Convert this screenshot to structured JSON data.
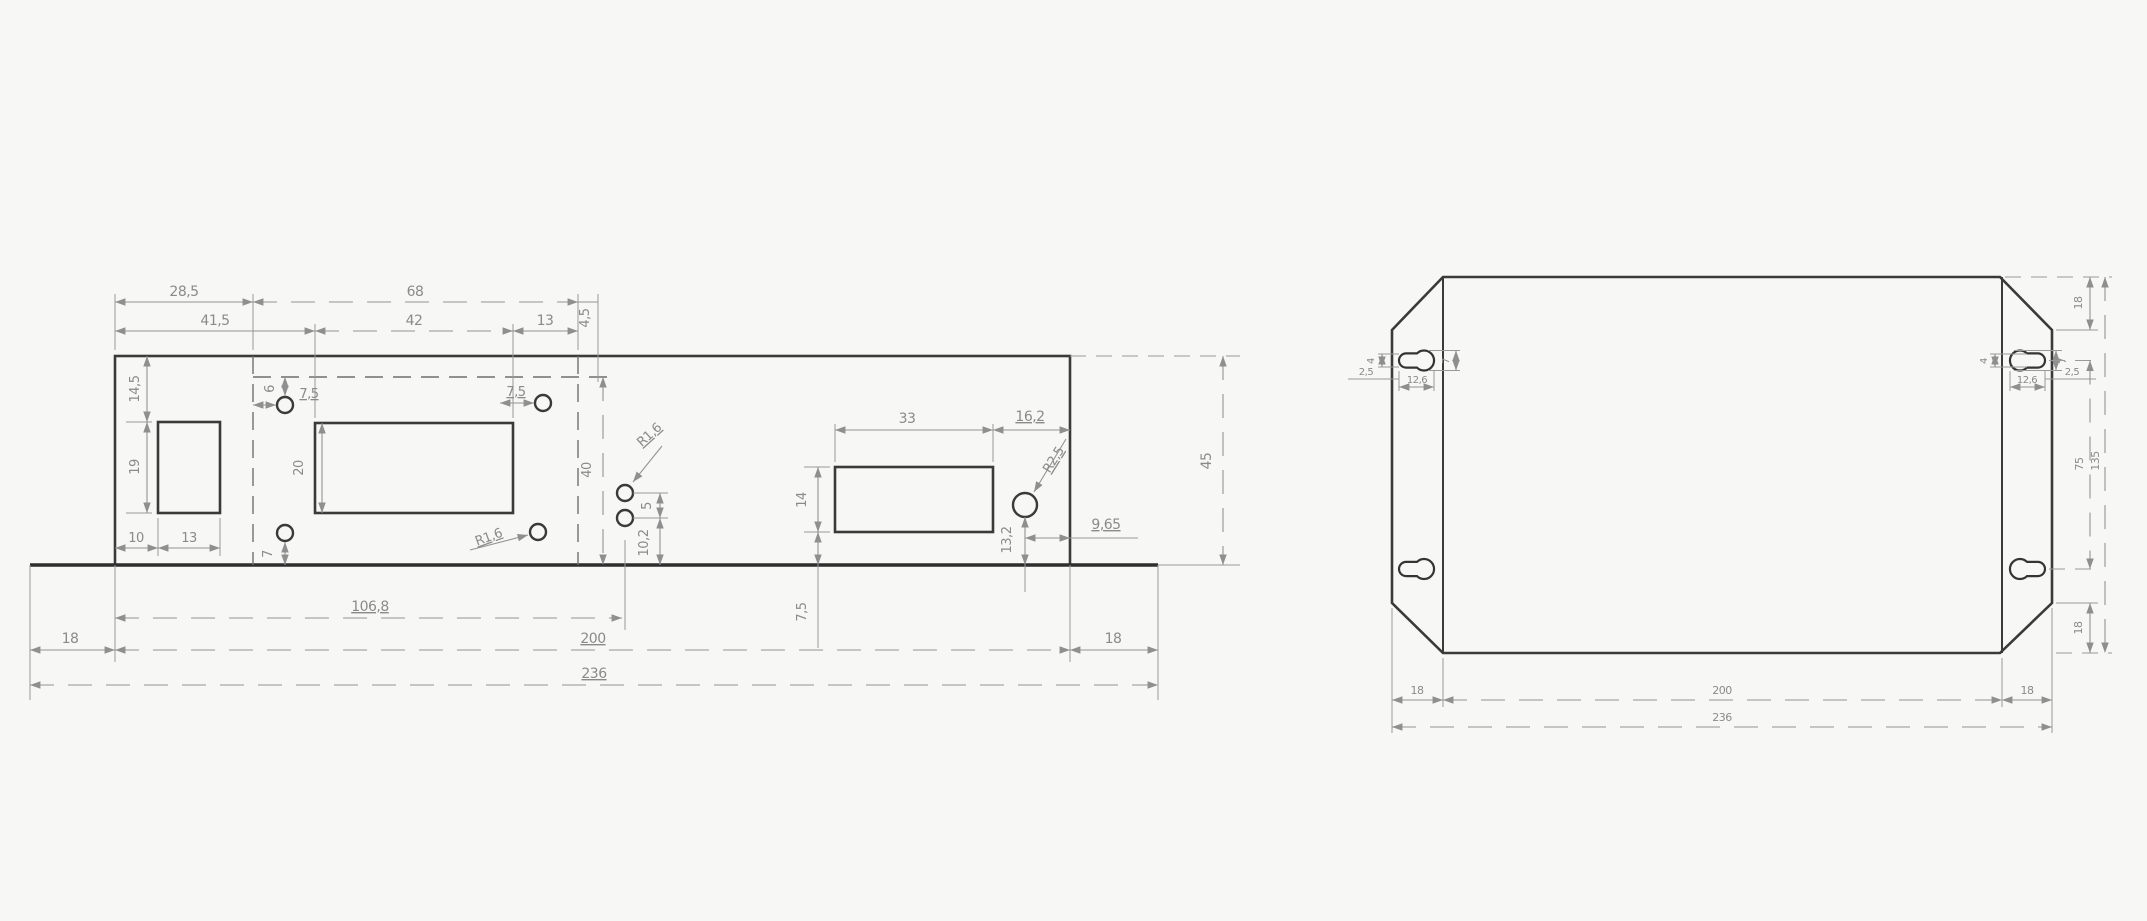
{
  "front_view": {
    "top1_a": "28,5",
    "top1_b": "68",
    "top1_c": "4,5",
    "top2_a": "41,5",
    "top2_b": "42",
    "top2_c": "13",
    "left_a": "14,5",
    "left_b": "19",
    "left_c": "10",
    "left_d": "13",
    "hole_offset": "6",
    "hole_left": "7,5",
    "hole_right": "7,5",
    "hole_bottom": "7",
    "cutout_h": "20",
    "fold_h": "40",
    "r_top": "R1,6",
    "r_mid": "R1,6",
    "gap": "5",
    "pair_bottom": "10,2",
    "rc_w": "33",
    "rc_edge": "16,2",
    "rc_h": "14",
    "rc_r": "R2,5",
    "rc_hole_bottom": "13,2",
    "rc_hole_edge": "9,65",
    "rc_bottom": "7,5",
    "b_flange_l": "18",
    "b_hole_x": "106,8",
    "b_body": "200",
    "b_flange_r": "18",
    "b_total": "236",
    "height": "45"
  },
  "top_view": {
    "lk_w": "4",
    "lk_gap": "2,5",
    "lk_len": "12,6",
    "lk_dia": "7",
    "rk_w": "4",
    "rk_gap": "2,5",
    "rk_len": "12,6",
    "rk_dia": "7",
    "r_top18": "18",
    "r_75": "75",
    "r_135": "135",
    "r_bot18": "18",
    "b_l18": "18",
    "b_200": "200",
    "b_r18": "18",
    "b_236": "236"
  }
}
